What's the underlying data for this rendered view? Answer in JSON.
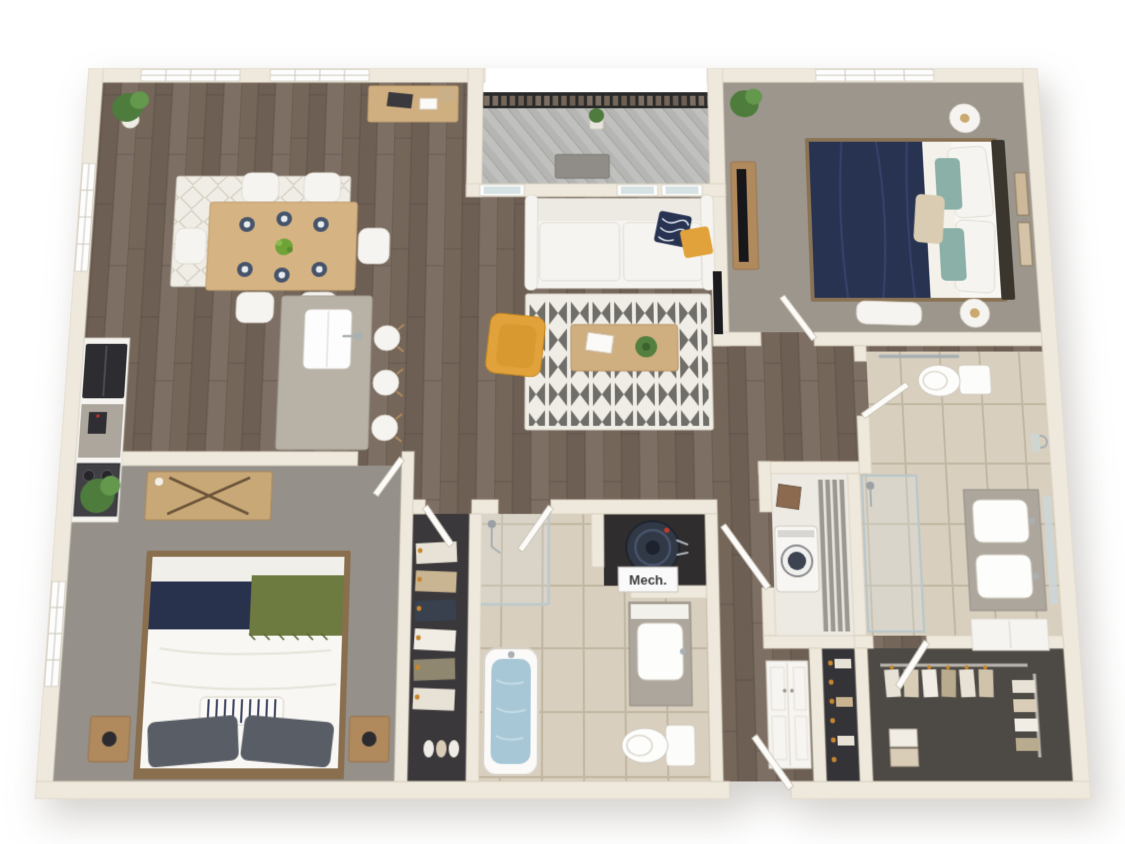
{
  "scene": {
    "type": "3d-floor-plan-rendering",
    "text_labels": {
      "mech": "Mech."
    },
    "rooms": [
      {
        "name": "dining-area",
        "floor": "wood",
        "items": [
          "dining-table",
          "six-chairs",
          "table-settings",
          "area-rug",
          "potted-plant",
          "console-table",
          "two-top-windows",
          "left-window"
        ]
      },
      {
        "name": "balcony",
        "floor": "deck",
        "items": [
          "metal-railing",
          "doormat",
          "potted-plant"
        ]
      },
      {
        "name": "living-room",
        "floor": "wood",
        "items": [
          "sofa",
          "navy-pillow",
          "yellow-pillow",
          "zigzag-rug",
          "coffee-table",
          "yellow-armchair",
          "balcony-door",
          "windows",
          "wall-tv"
        ]
      },
      {
        "name": "kitchen",
        "floor": "wood",
        "items": [
          "cabinets",
          "refrigerator",
          "range",
          "coffee-maker",
          "island-with-sink",
          "three-bar-stools"
        ]
      },
      {
        "name": "bedroom-1",
        "floor": "carpet",
        "items": [
          "bed-navy-duvet",
          "headboard",
          "round-nightstands",
          "lamps",
          "teal-pillows",
          "wall-art",
          "tv-console",
          "bench",
          "window",
          "plant"
        ]
      },
      {
        "name": "bathroom-1",
        "floor": "tile",
        "items": [
          "toilet",
          "grab-bars",
          "towel-ring",
          "walk-in-shower",
          "double-vanity",
          "mirror",
          "storage-cabinet"
        ]
      },
      {
        "name": "laundry-closet",
        "floor": "vinyl",
        "items": [
          "washer",
          "wire-shelving",
          "board"
        ]
      },
      {
        "name": "bedroom-2",
        "floor": "carpet",
        "items": [
          "bed-navy-green",
          "striped-pillow",
          "wood-nightstands",
          "lamps",
          "dresser",
          "plant",
          "window"
        ]
      },
      {
        "name": "walk-in-closet-1",
        "floor": "dark",
        "items": [
          "hanging-clothes",
          "hooks",
          "shoes"
        ]
      },
      {
        "name": "bathroom-2",
        "floor": "tile",
        "items": [
          "bathtub-with-water",
          "shower-fixtures",
          "vanity-sink",
          "toilet"
        ]
      },
      {
        "name": "mechanical-closet",
        "floor": "dark",
        "items": [
          "water-heater",
          "mech-label"
        ]
      },
      {
        "name": "hallway",
        "floor": "wood",
        "items": [
          "entry-door"
        ]
      },
      {
        "name": "linen-closet",
        "floor": "wood",
        "items": [
          "double-door-cabinet"
        ]
      },
      {
        "name": "reach-in-closet",
        "floor": "dark",
        "items": [
          "hooks",
          "hanging-items"
        ]
      },
      {
        "name": "walk-in-closet-2",
        "floor": "carpet",
        "items": [
          "hanging-clothes",
          "rods",
          "folded-stacks"
        ]
      }
    ]
  },
  "colors": {
    "background": "#ffffff",
    "wall": "#efe9dd",
    "wall_edge": "#d8d0bf",
    "wood_base": "#75665a",
    "carpet_1": "#9c968d",
    "carpet_2": "#95908a",
    "tile_base": "#d8cfbe",
    "deck": "#c0c0be",
    "railing": "#2a2a2a",
    "closet1_floor": "#3a383a",
    "closet2_floor": "#4d4944",
    "reachin_floor": "#343338",
    "laundry_floor": "#edeae4",
    "mech_floor": "#2f2d2e",
    "navy": "#283352",
    "navy_2": "#29324d",
    "yellow": "#e2a23b",
    "green_throw": "#6d7a40",
    "plant_green": "#4e7c3c",
    "water": "#a7c7d7",
    "wood_furniture": "#cfae80",
    "wood_furniture_2": "#b08a5c",
    "white_furn": "#f6f4f0",
    "counter_gray": "#aca69c",
    "island_gray": "#b7b1a6",
    "appliance_dark": "#2c2c31",
    "rug_light": "#f0ede6",
    "hanger_orange": "#c8872e",
    "heater_navy": "#313947",
    "teal_pillow": "#8ab0a8"
  }
}
